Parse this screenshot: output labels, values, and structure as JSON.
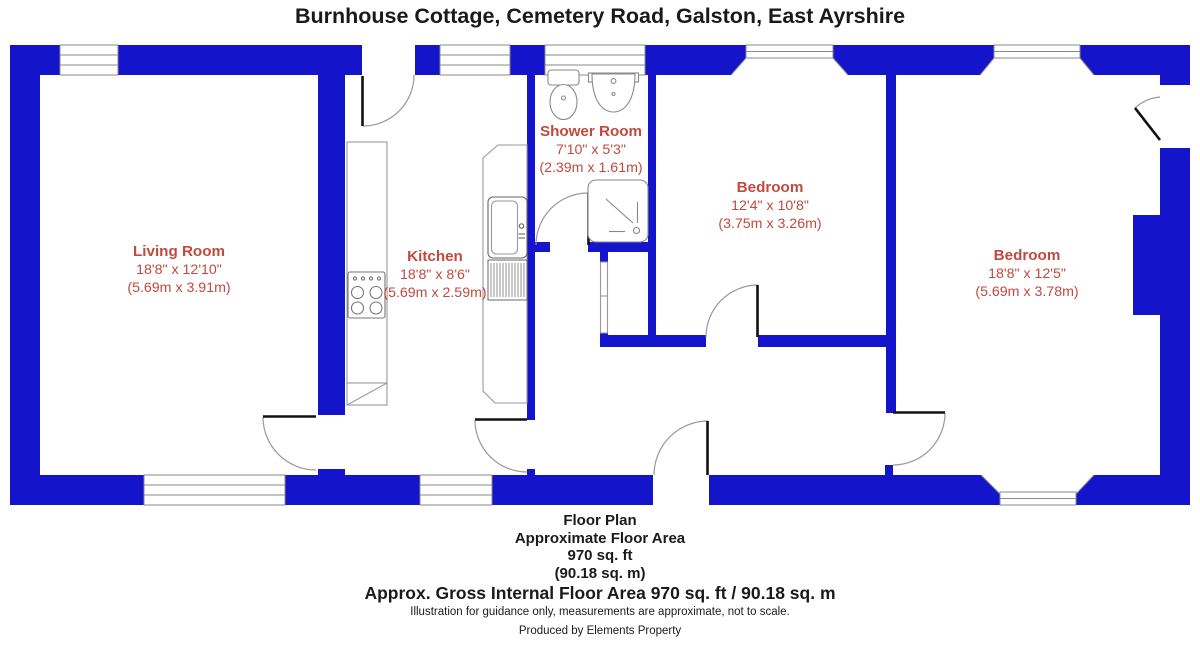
{
  "title": "Burnhouse Cottage, Cemetery Road, Galston, East Ayrshire",
  "colors": {
    "wall_blue": "#1414CB",
    "label_red": "#C2493E",
    "door_leaf_black": "#111111",
    "arc_gray": "#999999",
    "fixture_gray": "#9a9a9a",
    "text_black": "#1a1a1a"
  },
  "rooms": {
    "living_room": {
      "name": "Living Room",
      "size_imperial": "18'8\" x 12'10\"",
      "size_metric": "(5.69m x 3.91m)"
    },
    "kitchen": {
      "name": "Kitchen",
      "size_imperial": "18'8\" x 8'6\"",
      "size_metric": "(5.69m x 2.59m)"
    },
    "shower_room": {
      "name": "Shower Room",
      "size_imperial": "7'10\" x 5'3\"",
      "size_metric": "(2.39m x 1.61m)"
    },
    "bedroom_1": {
      "name": "Bedroom",
      "size_imperial": "12'4\" x 10'8\"",
      "size_metric": "(3.75m x 3.26m)"
    },
    "bedroom_2": {
      "name": "Bedroom",
      "size_imperial": "18'8\" x 12'5\"",
      "size_metric": "(5.69m x 3.78m)"
    }
  },
  "fixtures": [
    "toilet",
    "wash-basin",
    "shower-tray",
    "hob",
    "kitchen-sink",
    "drainer",
    "worktop",
    "cupboard-door"
  ],
  "footer": {
    "plan_title": "Floor Plan",
    "area_label": "Approximate Floor Area",
    "area_sqft": "970 sq. ft",
    "area_sqm": "(90.18 sq. m)",
    "gross_area": "Approx. Gross Internal Floor Area 970 sq. ft / 90.18 sq. m",
    "disclaimer": "Illustration for guidance only, measurements are approximate, not to scale.",
    "credit": "Produced by Elements Property"
  }
}
